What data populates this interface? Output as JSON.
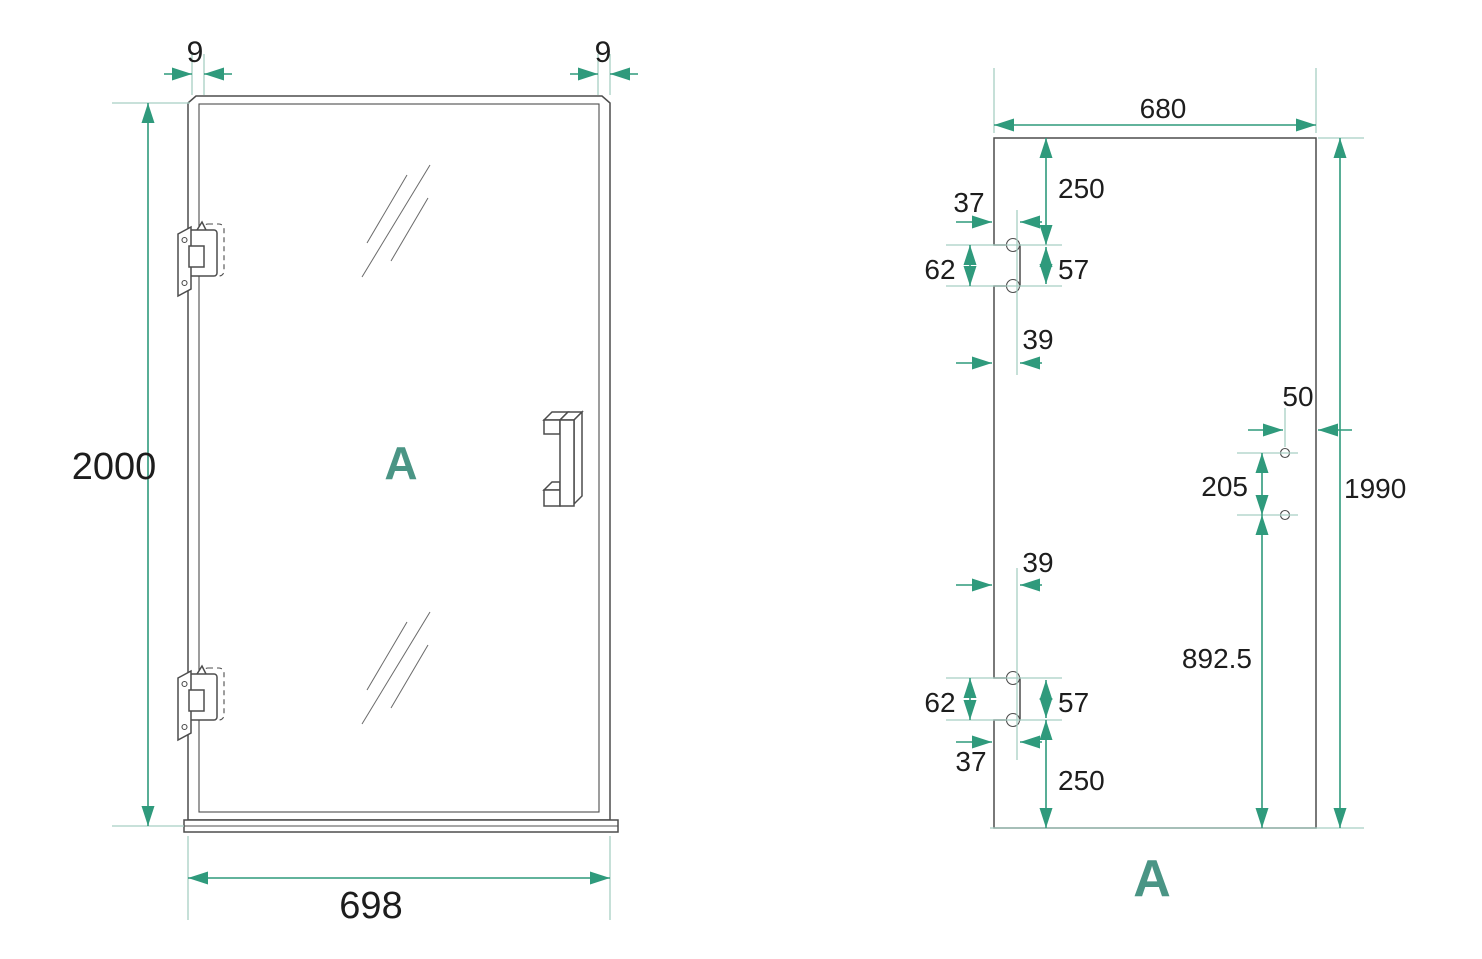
{
  "colors": {
    "dimension": "#2f9a7c",
    "extension": "#a7cfc4",
    "outline": "#4d4d4d",
    "label": "#1d1d1d",
    "view_label": "#4a9585",
    "background": "#ffffff"
  },
  "views": {
    "front": {
      "name_label": "A",
      "dims": {
        "frame_left": "9",
        "frame_right": "9",
        "height": "2000",
        "width": "698"
      }
    },
    "glass_panel": {
      "name_label": "A",
      "dims": {
        "width": "680",
        "height": "1990",
        "hinge_top_offset": "250",
        "hinge_top_edge_gap": "37",
        "hinge_top_cutout": "62",
        "hinge_top_holes": "57",
        "hinge_top_center": "39",
        "handle_edge_gap": "50",
        "handle_hole_spacing": "205",
        "handle_to_bottom": "892.5",
        "hinge_bottom_center": "39",
        "hinge_bottom_cutout": "62",
        "hinge_bottom_holes": "57",
        "hinge_bottom_edge_gap": "37",
        "hinge_bottom_offset": "250"
      }
    }
  }
}
